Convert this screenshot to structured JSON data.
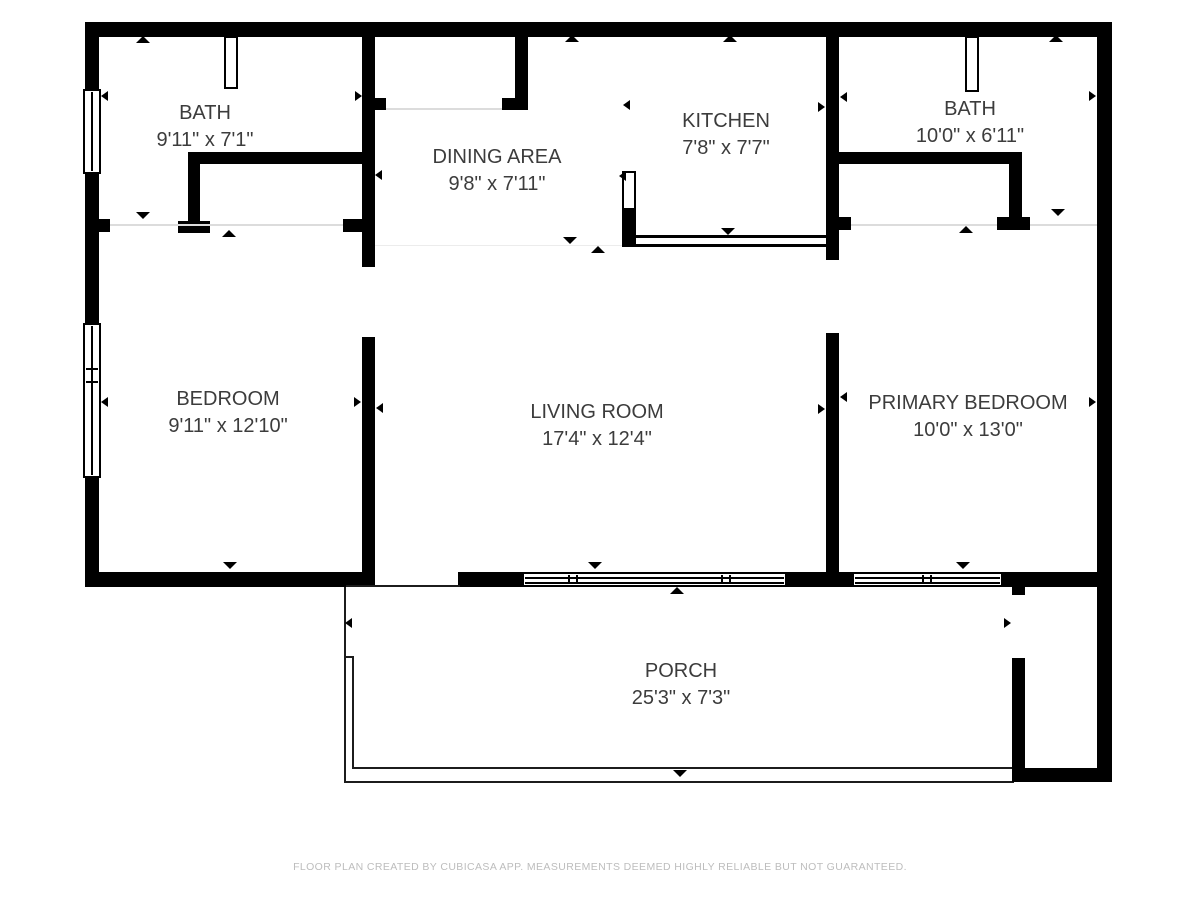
{
  "meta": {
    "app_credit": "FLOOR PLAN CREATED BY CUBICASA APP. MEASUREMENTS DEEMED HIGHLY RELIABLE BUT NOT GUARANTEED."
  },
  "rooms": {
    "bath_left": {
      "name": "BATH",
      "dims": "9'11\" x 7'1\""
    },
    "dining": {
      "name": "DINING AREA",
      "dims": "9'8\" x 7'11\""
    },
    "kitchen": {
      "name": "KITCHEN",
      "dims": "7'8\" x 7'7\""
    },
    "bath_right": {
      "name": "BATH",
      "dims": "10'0\" x 6'11\""
    },
    "bedroom": {
      "name": "BEDROOM",
      "dims": "9'11\" x 12'10\""
    },
    "living": {
      "name": "LIVING ROOM",
      "dims": "17'4\" x 12'4\""
    },
    "primary": {
      "name": "PRIMARY BEDROOM",
      "dims": "10'0\" x 13'0\""
    },
    "porch": {
      "name": "PORCH",
      "dims": "25'3\" x 7'3\""
    }
  },
  "colors": {
    "wall": "#000000",
    "background": "#ffffff",
    "label_text": "#3c3c3c",
    "footer_text": "#bdbdbd"
  }
}
